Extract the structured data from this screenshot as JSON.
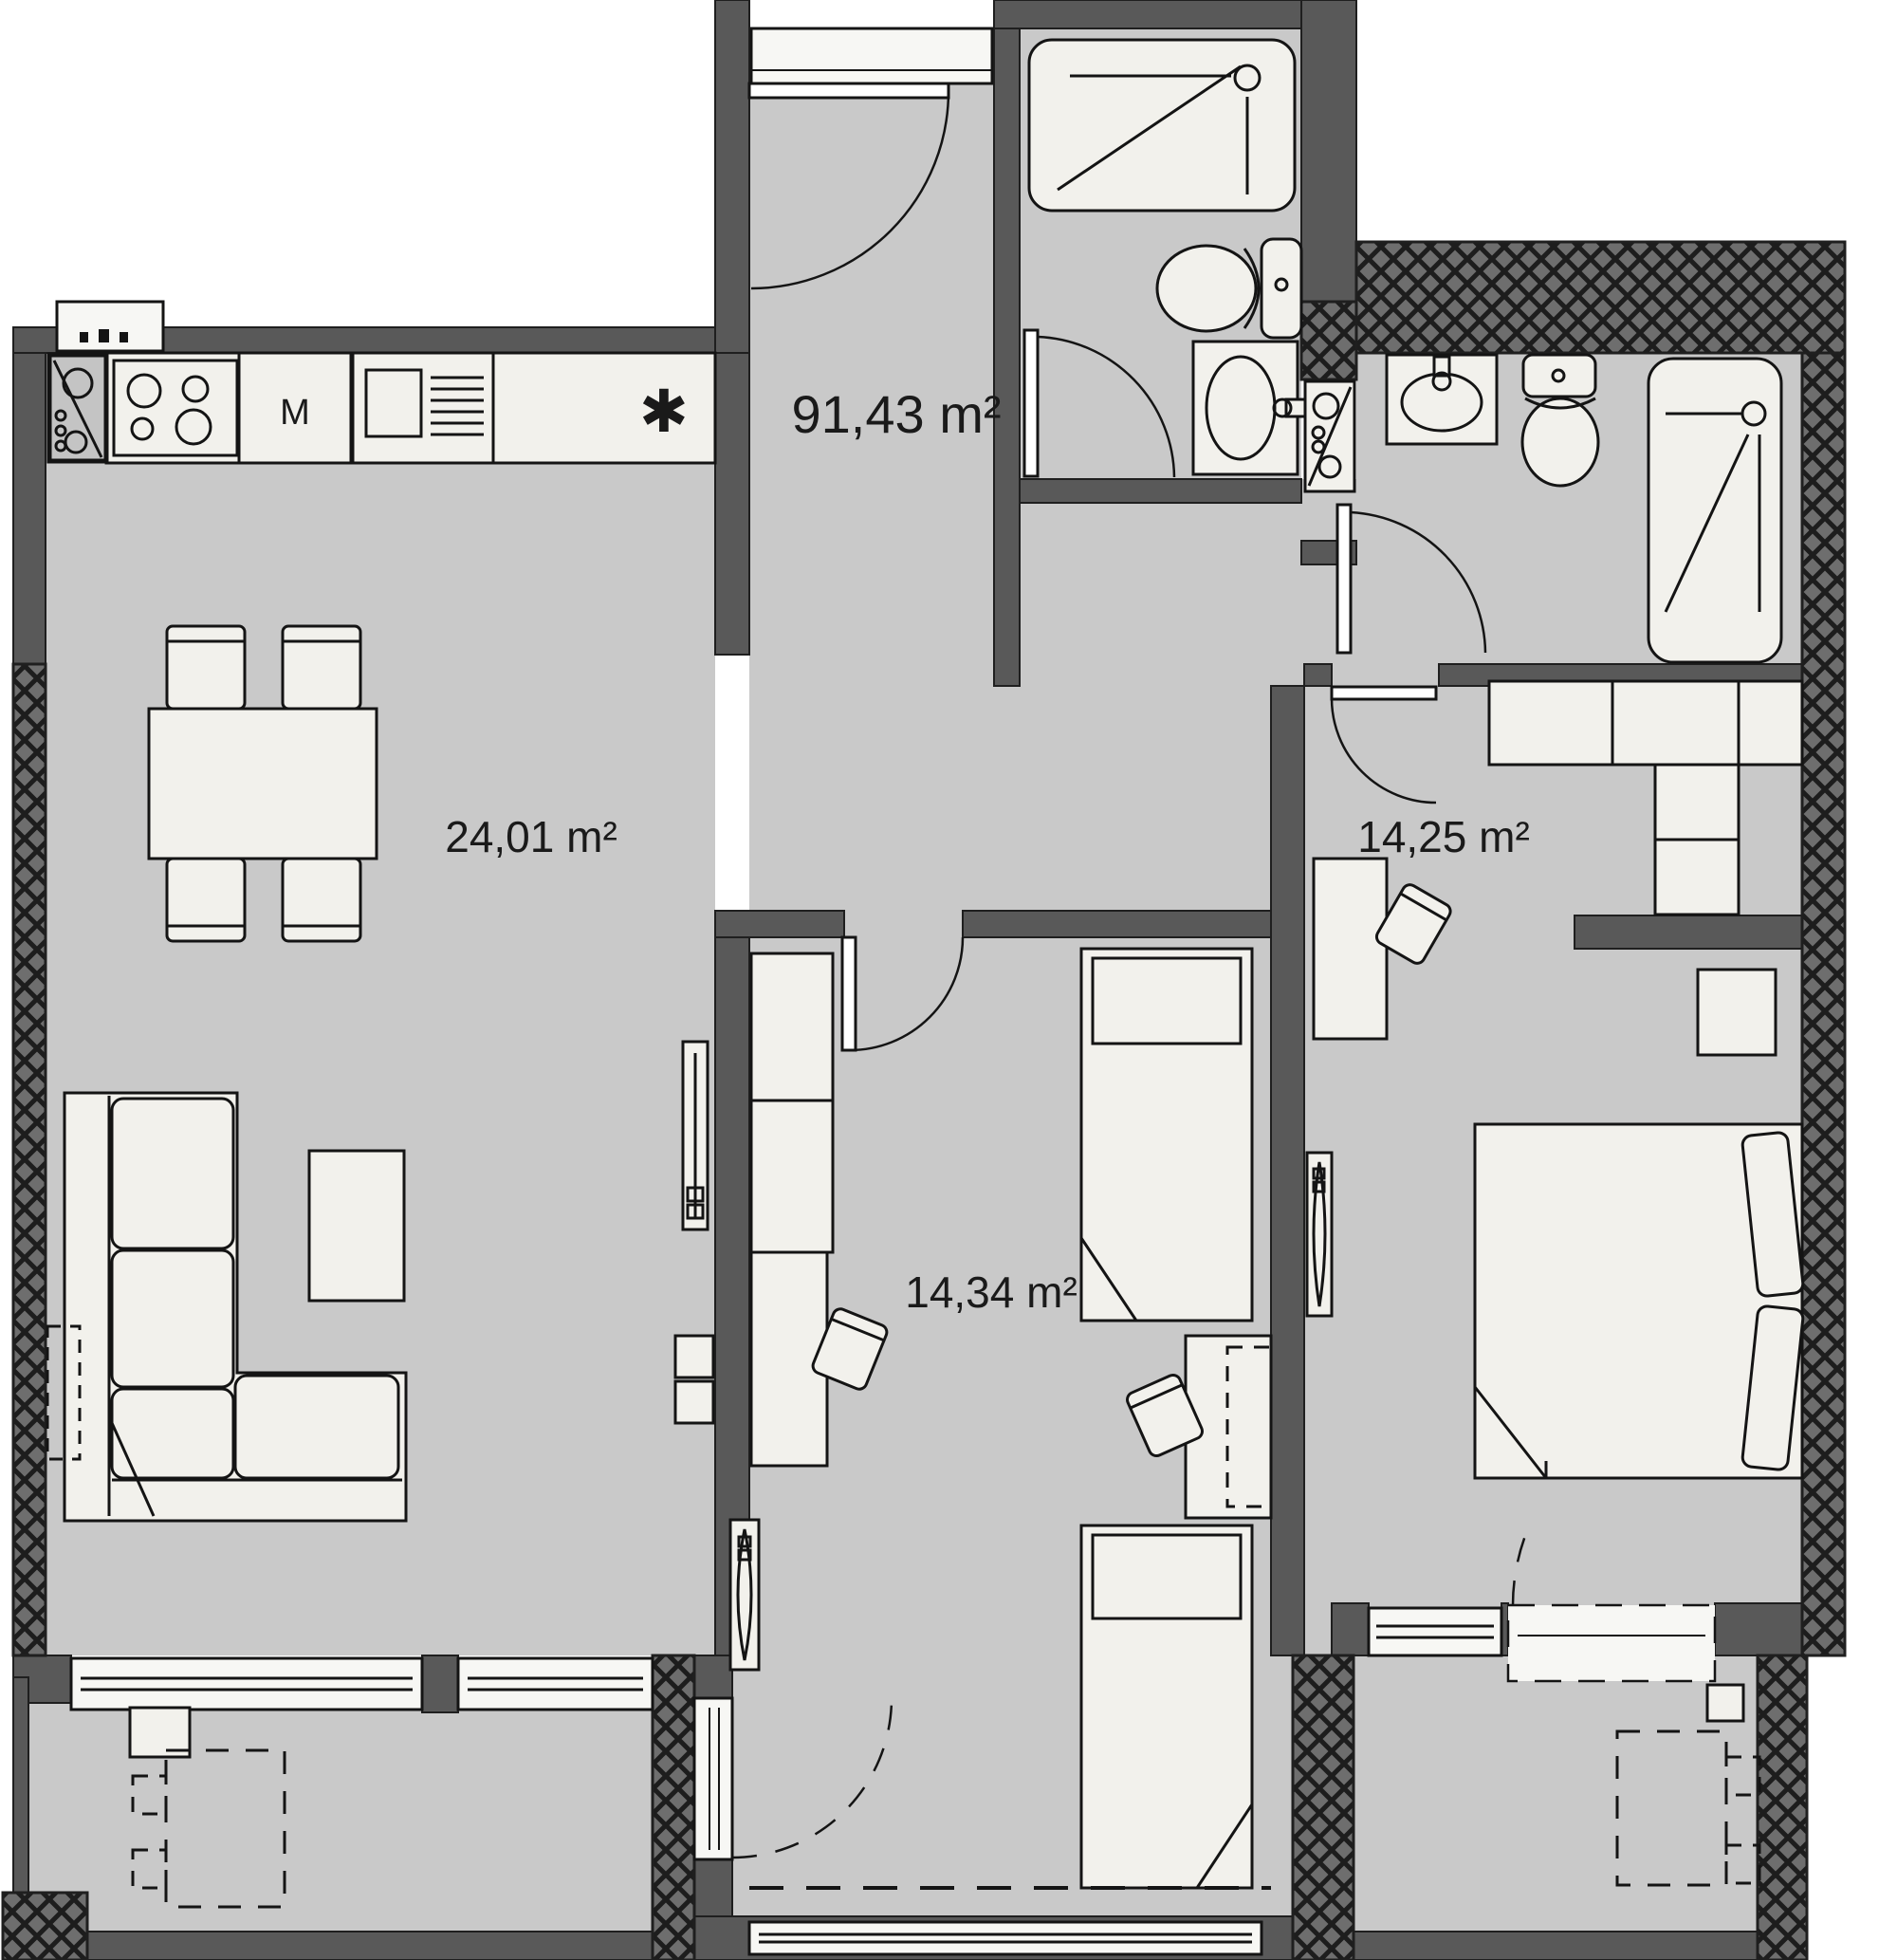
{
  "plan": {
    "type": "apartment-floor-plan",
    "areas": {
      "total": "91,43 m²",
      "living_kitchen": "24,01 m²",
      "bedroom_right": "14,25 m²",
      "bedroom_middle": "14,34 m²"
    },
    "kitchen": {
      "machine_label": "M",
      "counter_symbol": "✱"
    },
    "colors": {
      "wall": "#595959",
      "floor": "#c9c9c9",
      "furniture": "#f2f1ec",
      "hatch_background": "#6e6e6e",
      "outline": "#1a1a1a",
      "background": "#ffffff"
    },
    "fixtures": [
      "shower-tray",
      "toilet",
      "washbasin",
      "bathtub",
      "laundry-sink-unit",
      "kitchen-sink",
      "stove",
      "kitchen-machine",
      "dishwasher",
      "kitchen-counter",
      "dining-table",
      "chair",
      "sofa-l-shaped",
      "coffee-table",
      "tv-panel",
      "media-shelf",
      "wardrobe",
      "desk",
      "single-bed",
      "double-bed",
      "nightstand",
      "radiator",
      "balcony-table-dashed",
      "planter",
      "entrance-door",
      "interior-door",
      "balcony-door",
      "window"
    ]
  }
}
